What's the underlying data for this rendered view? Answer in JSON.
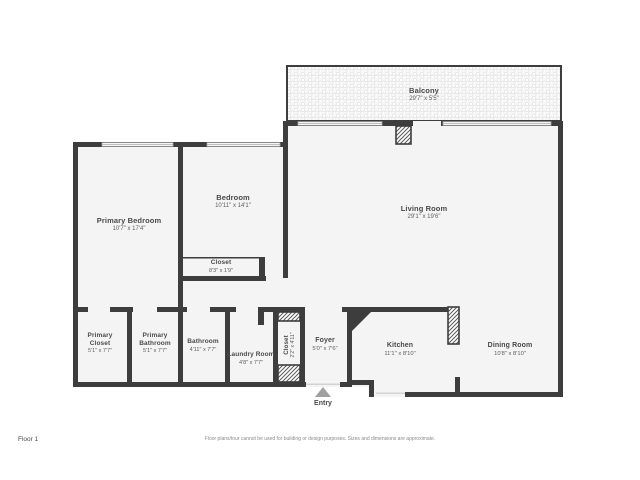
{
  "page": {
    "floor_label": "Floor 1",
    "entry_label": "Entry",
    "disclaimer": "Floor plans/tour cannot be used for building or design purposes. Sizes and dimensions are approximate."
  },
  "colors": {
    "wall": "#3d3d3d",
    "room_fill": "#f4f4f4",
    "balcony_fill": "#f7f7f7",
    "window_line": "#a8a8a8",
    "name_text": "#4a4a4a",
    "dims_text": "#5d5d5d",
    "entry_arrow": "#a0a0a0",
    "disclaimer_text": "#8a8a8a"
  },
  "icons": {
    "entry_arrow": "triangle-up",
    "balcony_texture": "pebble-dots",
    "column_texture": "diagonal-hatch"
  },
  "rooms": {
    "balcony": {
      "name": "Balcony",
      "dims": "29'7\" x 5'5\""
    },
    "primary_bedroom": {
      "name": "Primary Bedroom",
      "dims": "10'7\" x 17'4\""
    },
    "bedroom": {
      "name": "Bedroom",
      "dims": "10'11\" x 14'1\""
    },
    "bedroom_closet": {
      "name": "Closet",
      "dims": "8'3\" x 1'9\""
    },
    "living_room": {
      "name": "Living Room",
      "dims": "29'1\" x 19'6\""
    },
    "primary_closet": {
      "name": "Primary Closet",
      "dims": "5'1\" x 7'7\""
    },
    "primary_bathroom": {
      "name": "Primary Bathroom",
      "dims": "5'1\" x 7'7\""
    },
    "bathroom": {
      "name": "Bathroom",
      "dims": "4'11\" x 7'7\""
    },
    "laundry_room": {
      "name": "Laundry Room",
      "dims": "4'8\" x 7'7\""
    },
    "hall_closet": {
      "name": "Closet",
      "dims": "2'2\" x 4'11\""
    },
    "foyer": {
      "name": "Foyer",
      "dims": "5'0\" x 7'6\""
    },
    "kitchen": {
      "name": "Kitchen",
      "dims": "11'1\" x 8'10\""
    },
    "dining_room": {
      "name": "Dining Room",
      "dims": "10'8\" x 8'10\""
    }
  }
}
